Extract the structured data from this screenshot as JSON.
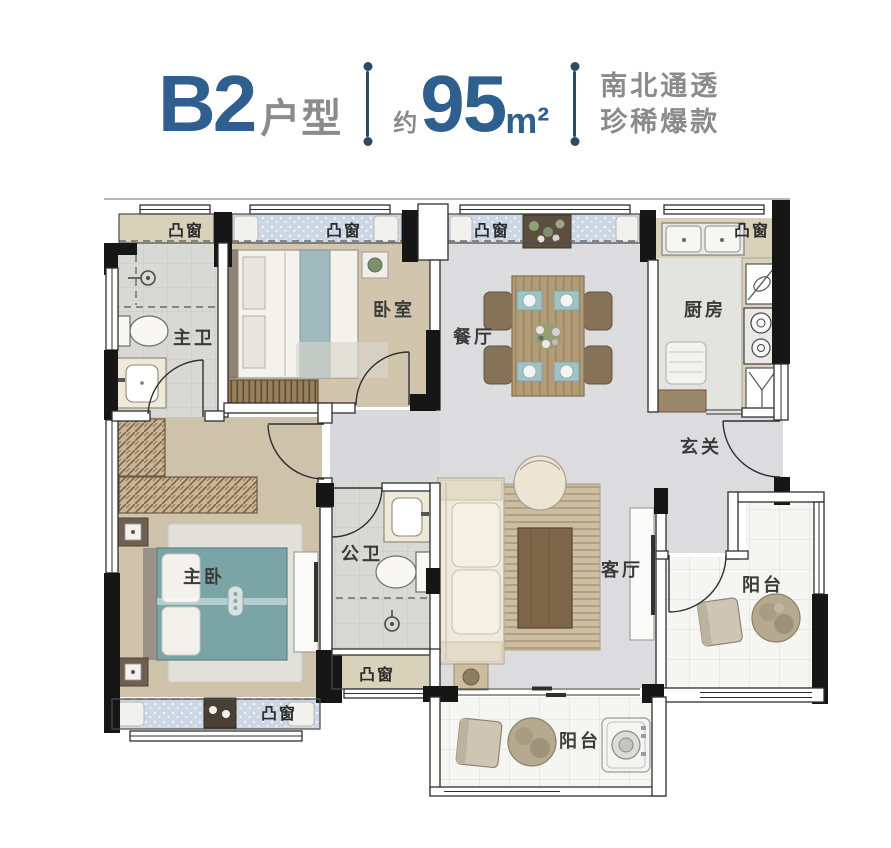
{
  "header": {
    "plan_code": "B2",
    "plan_type_suffix": "户型",
    "area_prefix": "约",
    "area_value": "95",
    "area_unit": "m²",
    "tagline_line1": "南北通透",
    "tagline_line2": "珍稀爆款",
    "accent_color": "#2f5f8e",
    "text_gray": "#8b8b8b",
    "divider_color": "#2b4a63"
  },
  "labels": {
    "bay_window": "凸窗"
  },
  "rooms": {
    "master_bath": "主卫",
    "second_bedroom": "卧室",
    "dining_room": "餐厅",
    "kitchen": "厨房",
    "entry_hall": "玄关",
    "guest_bath": "公卫",
    "master_bedroom": "主卧",
    "living_room": "客厅",
    "side_balcony": "阳台",
    "south_balcony": "阳台"
  },
  "palette": {
    "wall_black": "#161616",
    "wood_floor": "#d2c5ae",
    "gray_floor": "#dcdcde",
    "tile_floor": "#d8d8d5",
    "bay_window_blue": "#ccd7e3",
    "counter_khaki": "#d8d2ba",
    "bed_teal": "#7ba4a7",
    "table_wood": "#b29b77",
    "cabinet_brown": "#9b8769",
    "sofa_cream": "#efe9da"
  }
}
